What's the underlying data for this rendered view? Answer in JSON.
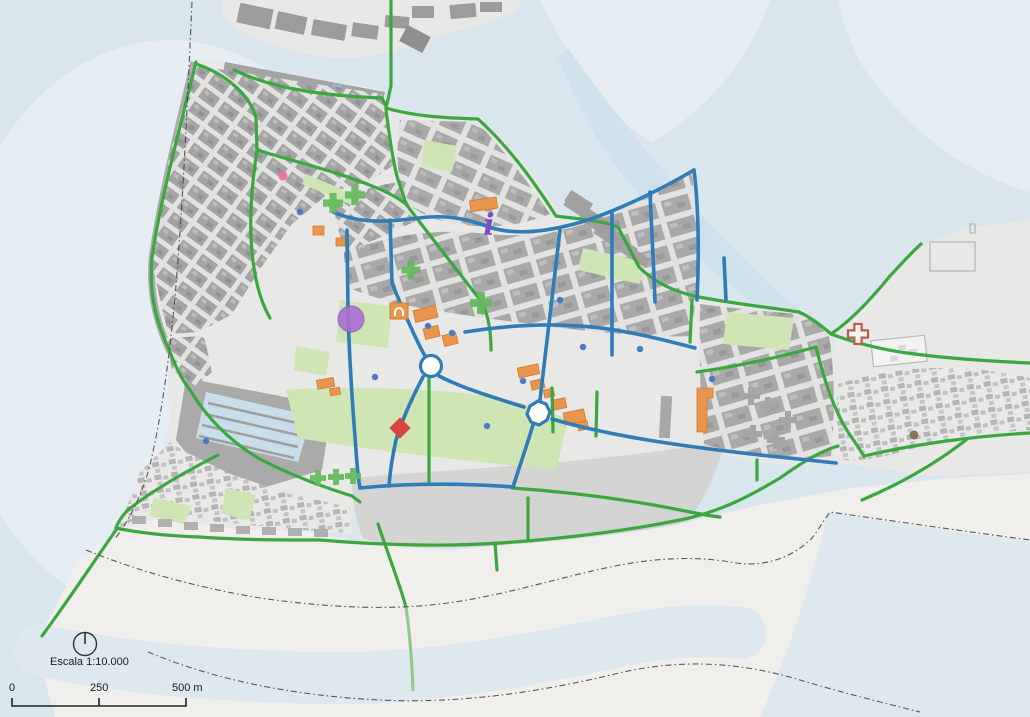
{
  "map": {
    "type": "city-map-export",
    "scale_bar": {
      "title": "Escala 1:10.000",
      "ticks": [
        "0",
        "250",
        "500 m"
      ]
    },
    "north_arrow": {
      "symbol": "circle-with-top-line"
    },
    "colors": {
      "water": "#d9e6ed",
      "water-light": "#e6eef3",
      "water-channel": "#cddfe9",
      "water-basin": "#c8deea",
      "sea-strip": "#dde9ef",
      "land": "#e8e8e6",
      "sand": "#f0efeb",
      "esplanade": "#d4d4d2",
      "street": "#e2e2e0",
      "block": "#a9a9a9",
      "block-light": "#c3c3c3",
      "quay": "#a3a3a3",
      "dark-building": "#9c9c9c",
      "park": "#cfe5b4",
      "route-green": "#3aa83e",
      "route-green-light": "#90ca8e",
      "route-blue": "#2e7cb8",
      "building-orange": "#e9954d",
      "building-orange-stroke": "#cf7c2e",
      "cross-green": "#63b95c",
      "hospital-red": "#b85c50",
      "dot-blue": "#4a7bc8",
      "dot-pink": "#f070a8",
      "dot-purple": "#a86fd2",
      "dot-brown": "#8a7355",
      "diamond-red": "#d8453e",
      "info-purple": "#7c4fc4",
      "boundary": "#3c3c3c",
      "text": "#1a1a1a"
    },
    "pois": [
      {
        "type": "pharmacy-cross",
        "x": 333,
        "y": 203,
        "s": 20
      },
      {
        "type": "pharmacy-cross",
        "x": 355,
        "y": 195,
        "s": 20
      },
      {
        "type": "pharmacy-cross",
        "x": 411,
        "y": 270,
        "s": 19
      },
      {
        "type": "pharmacy-cross",
        "x": 481,
        "y": 303,
        "s": 22
      },
      {
        "type": "pharmacy-cross",
        "x": 318,
        "y": 478,
        "s": 16
      },
      {
        "type": "pharmacy-cross",
        "x": 336,
        "y": 477,
        "s": 16
      },
      {
        "type": "pharmacy-cross",
        "x": 353,
        "y": 476,
        "s": 16
      },
      {
        "type": "hospital-cross",
        "x": 858,
        "y": 334,
        "s": 20
      },
      {
        "type": "info-point",
        "x": 489,
        "y": 224
      },
      {
        "type": "museum-building",
        "x": 399,
        "y": 311
      },
      {
        "type": "monument-circle",
        "x": 351,
        "y": 319
      },
      {
        "type": "red-diamond",
        "x": 400,
        "y": 428
      },
      {
        "type": "marker-dot",
        "x": 283,
        "y": 176,
        "color": "dot-pink",
        "r": 4.5
      },
      {
        "type": "marker-dot",
        "x": 914,
        "y": 435,
        "color": "dot-brown",
        "r": 4.5
      },
      {
        "type": "marker-dot",
        "x": 300,
        "y": 212,
        "color": "dot-blue",
        "r": 3.2
      },
      {
        "type": "marker-dot",
        "x": 428,
        "y": 326,
        "color": "dot-blue",
        "r": 3.2
      },
      {
        "type": "marker-dot",
        "x": 452,
        "y": 333,
        "color": "dot-blue",
        "r": 3.2
      },
      {
        "type": "marker-dot",
        "x": 523,
        "y": 381,
        "color": "dot-blue",
        "r": 3.2
      },
      {
        "type": "marker-dot",
        "x": 583,
        "y": 347,
        "color": "dot-blue",
        "r": 3.2
      },
      {
        "type": "marker-dot",
        "x": 640,
        "y": 349,
        "color": "dot-blue",
        "r": 3.2
      },
      {
        "type": "marker-dot",
        "x": 712,
        "y": 379,
        "color": "dot-blue",
        "r": 3.2
      },
      {
        "type": "marker-dot",
        "x": 487,
        "y": 426,
        "color": "dot-blue",
        "r": 3.2
      },
      {
        "type": "marker-dot",
        "x": 206,
        "y": 441,
        "color": "dot-blue",
        "r": 3.2
      },
      {
        "type": "marker-dot",
        "x": 560,
        "y": 300,
        "color": "dot-blue",
        "r": 3.2
      },
      {
        "type": "marker-dot",
        "x": 375,
        "y": 377,
        "color": "dot-blue",
        "r": 3.2
      }
    ]
  }
}
